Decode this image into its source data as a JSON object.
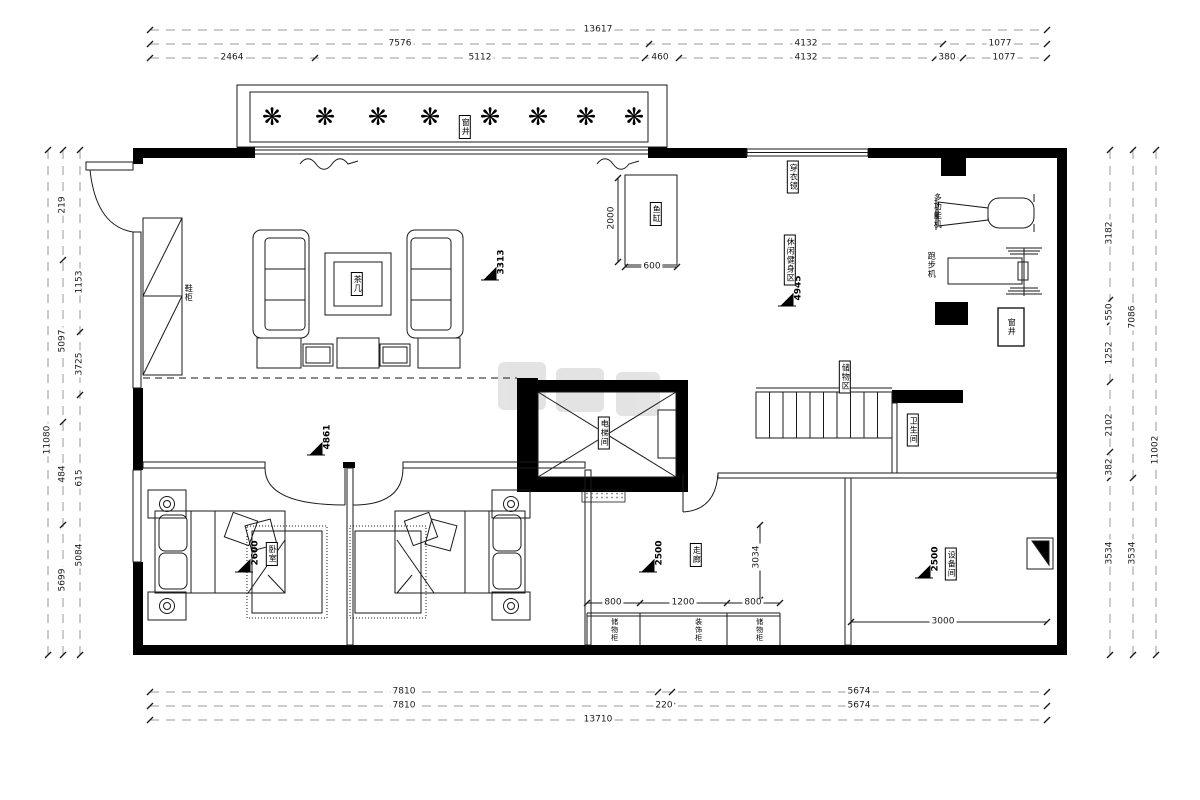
{
  "dims": {
    "top": {
      "total": "13617",
      "r2": [
        "7576",
        "4132",
        "1077"
      ],
      "r3": [
        "2464",
        "5112",
        "460",
        "4132",
        "380",
        "1077"
      ]
    },
    "bottom": {
      "r1": [
        "7810",
        "5674"
      ],
      "r2": [
        "7810",
        "220",
        "5674"
      ],
      "total": "13710"
    },
    "left": {
      "total": "11080",
      "mid": [
        "219",
        "5097",
        "484",
        "5699"
      ],
      "inner": [
        "1153",
        "3725",
        "615",
        "5084"
      ]
    },
    "right": {
      "inner": [
        "3182",
        "550",
        "1252",
        "2102",
        "382",
        "3534"
      ],
      "mid": [
        "7086",
        "3534"
      ],
      "total": "11002"
    },
    "inner": {
      "tank_h": "2000",
      "tank_w": "600",
      "cab": [
        "800",
        "1200",
        "800"
      ],
      "corridor_w": "3034",
      "equip_w": "3000"
    }
  },
  "levels": {
    "living": "3313",
    "fitness": "4945",
    "hall": "4861",
    "bedroom": "2600",
    "corridor": "2500",
    "equipment": "2500"
  },
  "labels": {
    "window_well_top": "窗井",
    "window_well_right": "窗井",
    "tea_table": "茶几",
    "shoe_cabinet": "鞋柜",
    "fish_tank": "鱼缸",
    "dressing_mirror": "穿衣镜",
    "fitness_area": "休闲健身区",
    "multi_machine": "多功能机",
    "treadmill": "跑步机",
    "storage_area": "储物区",
    "bathroom": "卫生间",
    "elevator": "电梯间",
    "bedroom": "卧室",
    "corridor": "走廊",
    "equipment_room": "设备间",
    "cabinet_left": "储物柜",
    "cabinet_mid": "装饰柜",
    "cabinet_right": "储物柜"
  },
  "icons": {
    "plant": "❋"
  },
  "colors": {
    "line": "#1a1a1a",
    "wall": "#000000",
    "dimline": "#9a9a9a"
  }
}
